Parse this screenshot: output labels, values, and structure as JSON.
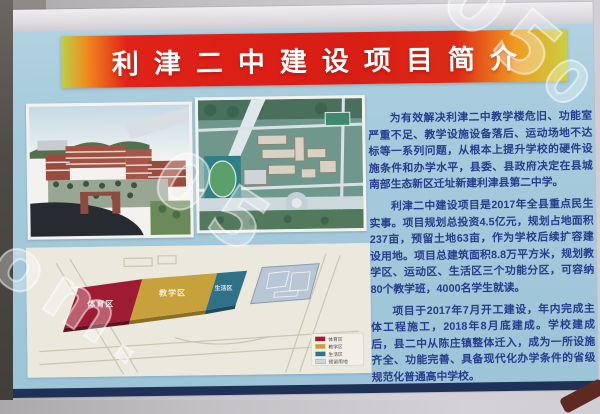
{
  "photo": {
    "watermarks": [
      "05",
      "05",
      "om.",
      "0"
    ]
  },
  "board": {
    "title": "利津二中建设项目简介",
    "colors": {
      "board_blue": "#a6cbdc",
      "banner_red": "#d81d15",
      "banner_edge_yellow": "#c9cf42",
      "body_text_navy": "#273c8f",
      "bottom_frame_navy": "#203158"
    },
    "paragraphs": [
      "为有效解决利津二中教学楼危旧、功能室严重不足、教学设施设备落后、运动场地不达标等一系列问题，从根本上提升学校的硬件设施条件和办学水平，县委、县政府决定在县城南部生态新区迁址新建利津县第二中学。",
      "利津二中建设项目是2017年全县重点民生实事。项目规划总投资4.5亿元，规划占地面积237亩，预留土地63亩，作为学校后续扩容建设用地。项目总建筑面积8.8万平方米，规划教学区、运动区、生活区三个功能分区，可容纳80个教学班，4000名学生就读。",
      "项目于2017年7月开工建设，年内完成主体工程施工，2018年8月底建成。学校建成后，县二中从陈庄镇整体迁入，成为一所设施齐全、功能完善、具备现代化办学条件的省级规范化普通高中学校。"
    ],
    "site_plan": {
      "zones": [
        {
          "label": "体育区",
          "color": "#9e1b32"
        },
        {
          "label": "教学区",
          "color": "#c7a13b"
        },
        {
          "label": "生活区",
          "color": "#2f7287"
        },
        {
          "label": "",
          "color": "#b9c6d6"
        }
      ],
      "legend": [
        {
          "label": "体育区",
          "color": "#9e1b32"
        },
        {
          "label": "教学区",
          "color": "#c7a13b"
        },
        {
          "label": "生活区",
          "color": "#2f7287"
        },
        {
          "label": "预留用地",
          "color": "#ccd6e0"
        }
      ]
    }
  }
}
